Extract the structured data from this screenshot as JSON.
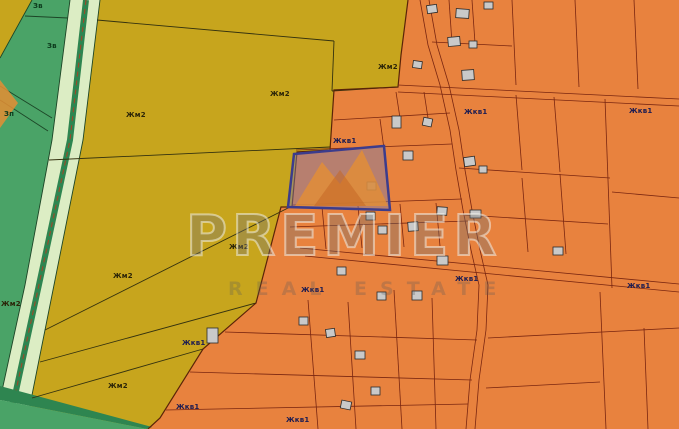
{
  "watermark": {
    "brand": "PREMIER",
    "tagline": "REAL ESTATE"
  },
  "zones": {
    "labels": [
      {
        "text": "Зв",
        "x": 33,
        "y": 2,
        "zone": "green"
      },
      {
        "text": "Зв",
        "x": 47,
        "y": 42,
        "zone": "green"
      },
      {
        "text": "Зп",
        "x": 4,
        "y": 110,
        "zone": "green"
      },
      {
        "text": "Жм2",
        "x": 126,
        "y": 111,
        "zone": "yellow"
      },
      {
        "text": "Жм2",
        "x": 270,
        "y": 90,
        "zone": "yellow"
      },
      {
        "text": "Жм2",
        "x": 378,
        "y": 63,
        "zone": "yellow"
      },
      {
        "text": "Жм2",
        "x": 229,
        "y": 243,
        "zone": "yellow"
      },
      {
        "text": "Жм2",
        "x": 113,
        "y": 272,
        "zone": "yellow"
      },
      {
        "text": "Жм2",
        "x": 1,
        "y": 300,
        "zone": "yellow"
      },
      {
        "text": "Жм2",
        "x": 108,
        "y": 382,
        "zone": "yellow"
      },
      {
        "text": "Жкв1",
        "x": 333,
        "y": 137,
        "zone": "orange"
      },
      {
        "text": "Жкв1",
        "x": 464,
        "y": 108,
        "zone": "orange"
      },
      {
        "text": "Жкв1",
        "x": 629,
        "y": 107,
        "zone": "orange"
      },
      {
        "text": "Жкв1",
        "x": 455,
        "y": 275,
        "zone": "orange"
      },
      {
        "text": "Жкв1",
        "x": 627,
        "y": 282,
        "zone": "orange"
      },
      {
        "text": "Жкв1",
        "x": 301,
        "y": 286,
        "zone": "orange"
      },
      {
        "text": "Жкв1",
        "x": 182,
        "y": 339,
        "zone": "orange"
      },
      {
        "text": "Жкв1",
        "x": 176,
        "y": 403,
        "zone": "orange"
      },
      {
        "text": "Жкв1",
        "x": 286,
        "y": 416,
        "zone": "orange"
      }
    ]
  },
  "colors": {
    "orange_zone": "#e8823e",
    "yellow_zone": "#c7a51d",
    "green_zone": "#4aa367",
    "pale_strip": "#dcedc4",
    "dark_green_road": "#2e8550",
    "building_fill": "#c9c9c9",
    "orange_boundary": "#7a2610",
    "yellow_boundary": "#34320f",
    "selected_parcel_border": "#3c3c8c"
  }
}
